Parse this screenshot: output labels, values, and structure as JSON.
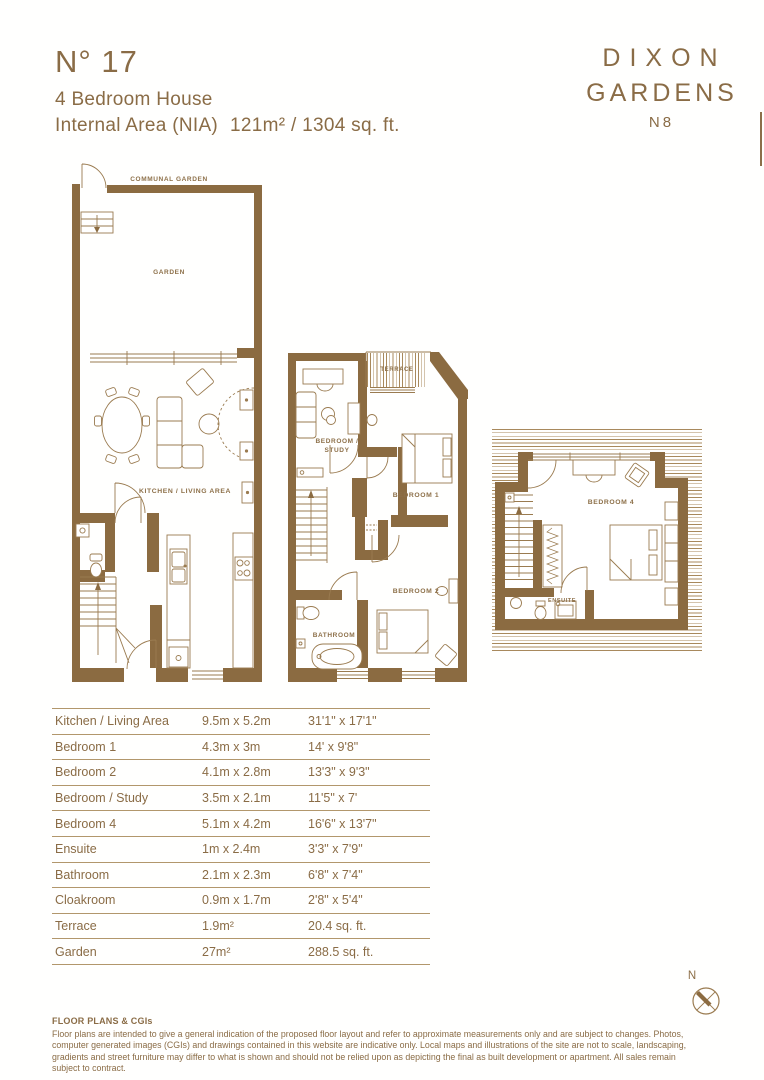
{
  "header": {
    "unit_number": "N° 17",
    "subtitle": "4 Bedroom House",
    "area_label": "Internal Area (NIA)",
    "area_value": "121m² / 1304 sq. ft."
  },
  "brand": {
    "line1": "DIXON",
    "line2": "GARDENS",
    "line3": "N8"
  },
  "plans": {
    "ground": {
      "communal_garden": "COMMUNAL GARDEN",
      "garden": "GARDEN",
      "kitchen_living": "KITCHEN / LIVING AREA"
    },
    "first": {
      "terrace": "TERRACE",
      "bedroom_study_line1": "BEDROOM /",
      "bedroom_study_line2": "STUDY",
      "bedroom1": "BEDROOM 1",
      "bedroom2": "BEDROOM 2",
      "bathroom": "BATHROOM"
    },
    "second": {
      "bedroom4": "BEDROOM 4",
      "ensuite": "ENSUITE"
    }
  },
  "dimensions_table": {
    "rows": [
      {
        "room": "Kitchen / Living Area",
        "metric": "9.5m x 5.2m",
        "imperial": "31'1\" x 17'1\""
      },
      {
        "room": "Bedroom 1",
        "metric": "4.3m x 3m",
        "imperial": "14' x 9'8\""
      },
      {
        "room": "Bedroom 2",
        "metric": "4.1m x 2.8m",
        "imperial": "13'3\" x 9'3\""
      },
      {
        "room": "Bedroom / Study",
        "metric": "3.5m x 2.1m",
        "imperial": "11'5\" x 7'"
      },
      {
        "room": "Bedroom 4",
        "metric": "5.1m x 4.2m",
        "imperial": "16'6\" x 13'7\""
      },
      {
        "room": "Ensuite",
        "metric": "1m x 2.4m",
        "imperial": "3'3\" x 7'9\""
      },
      {
        "room": "Bathroom",
        "metric": "2.1m x 2.3m",
        "imperial": "6'8\" x 7'4\""
      },
      {
        "room": "Cloakroom",
        "metric": "0.9m x 1.7m",
        "imperial": "2'8\" x 5'4\""
      },
      {
        "room": "Terrace",
        "metric": "1.9m²",
        "imperial": "20.4 sq. ft."
      },
      {
        "room": "Garden",
        "metric": "27m²",
        "imperial": "288.5 sq. ft."
      }
    ]
  },
  "compass": {
    "north_label": "N"
  },
  "footer": {
    "heading": "FLOOR PLANS & CGIs",
    "body": "Floor plans are intended to give a general indication of the proposed floor layout and refer to approximate measurements only and are subject to changes. Photos, computer generated images (CGIs) and drawings contained in this website are indicative only. Local maps and illustrations of the site are not to scale, landscaping, gradients and street furniture may differ to what is shown and should not be relied upon as depicting the final as built development or apartment. All sales remain subject to contract."
  },
  "colors": {
    "wall": "#8b6b41",
    "line": "#9a7b50",
    "text": "#8a6c46",
    "hatch": "#a8895c",
    "table_line": "#b2976c"
  }
}
